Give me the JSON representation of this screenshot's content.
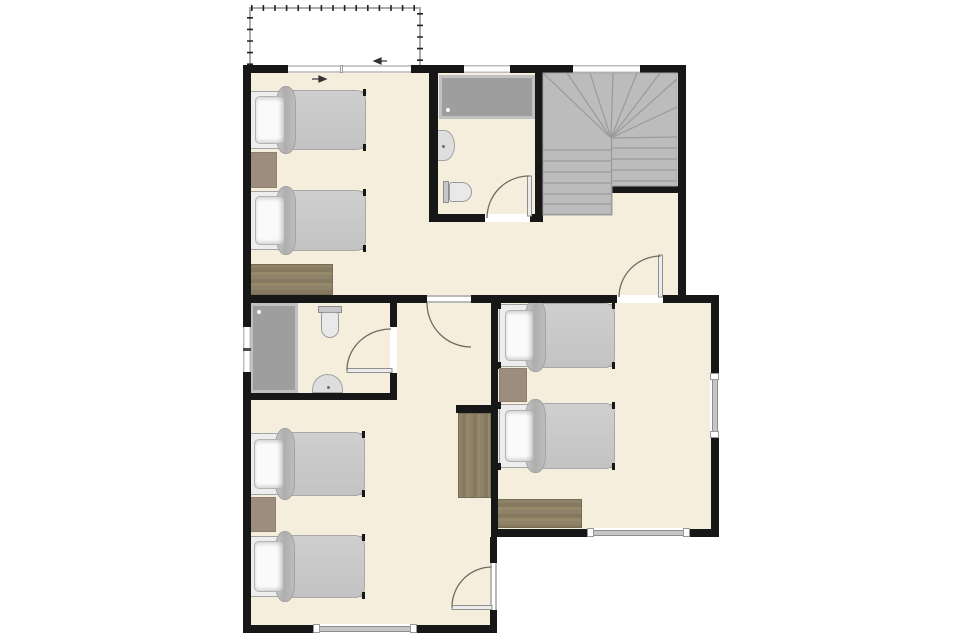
{
  "document": {
    "type": "architectural-floor-plan",
    "visible_text": "",
    "description": "Upper floor plan with two bathrooms, winder staircase, hallway, three twin-bed bedrooms and a balcony"
  },
  "colors": {
    "floor": "#f6eedc",
    "wall": "#171717",
    "glass": "#c6c6c6",
    "stairs": "#bcbcbc",
    "stair_line": "#9a9a9a",
    "shower": "#9e9e9e",
    "rug": "#9c8d7d",
    "wood": "#8c8066",
    "arc": "#6f6b60",
    "railing": "#ababab"
  },
  "rooms": [
    {
      "id": "balcony",
      "features": [
        "railing",
        "sliding-door"
      ]
    },
    {
      "id": "bedroom-upper-left",
      "furniture": [
        "single-bed",
        "single-bed",
        "rug",
        "dresser"
      ],
      "access": "open-passage-from-hallway"
    },
    {
      "id": "bathroom-upper",
      "furniture": [
        "bathtub-shower",
        "wash-basin",
        "toilet"
      ],
      "window": true,
      "door": "hinged-from-hallway"
    },
    {
      "id": "staircase",
      "type": "winder-stairs",
      "window": true
    },
    {
      "id": "hallway",
      "doors": [
        "to-middle-bedroom",
        "to-right-bedroom",
        "to-upper-bathroom"
      ]
    },
    {
      "id": "bathroom-middle",
      "furniture": [
        "shower",
        "toilet",
        "wash-basin"
      ],
      "window": true,
      "door": "hinged-from-middle-bedroom"
    },
    {
      "id": "bedroom-middle",
      "furniture": [
        "single-bed",
        "single-bed",
        "rug",
        "wardrobe"
      ],
      "windows": 1,
      "exterior_door": true
    },
    {
      "id": "bedroom-right",
      "furniture": [
        "single-bed",
        "single-bed",
        "rug",
        "dresser"
      ],
      "windows": 2
    }
  ],
  "counts": {
    "beds": 6,
    "bathrooms": 2,
    "doors": 5,
    "windows": 7
  }
}
